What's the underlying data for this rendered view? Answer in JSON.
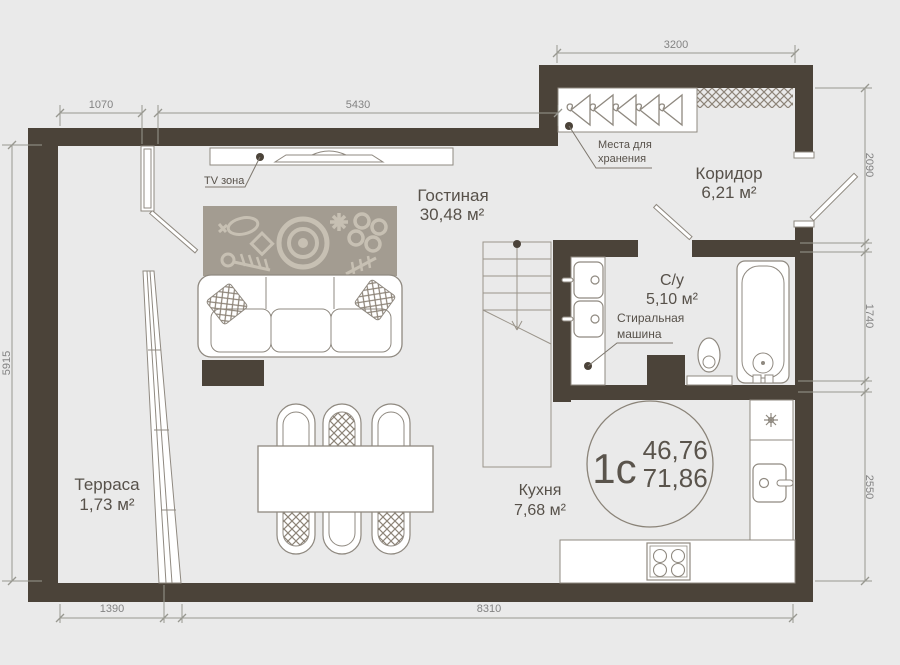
{
  "colors": {
    "background": "#eaeaea",
    "wall": "#4b4339",
    "furniture_outline": "#8f8980",
    "rug": "#a39c91",
    "rug_motif": "#c7c0b3",
    "pattern_accent": "#8d8478",
    "label_text": "#57514a",
    "dimension_text": "#838383"
  },
  "rooms": [
    {
      "id": "living",
      "name": "Гостиная",
      "area": "30,48 м²"
    },
    {
      "id": "corridor",
      "name": "Коридор",
      "area": "6,21 м²"
    },
    {
      "id": "bathroom",
      "name": "С/у",
      "area": "5,10 м²"
    },
    {
      "id": "kitchen",
      "name": "Кухня",
      "area": "7,68  м²"
    },
    {
      "id": "terrace",
      "name": "Терраса",
      "area": "1,73 м²"
    }
  ],
  "annotations": {
    "tv_zone": "TV зона",
    "storage": [
      "Места для",
      "хранения"
    ],
    "washing_machine": [
      "Стиральная",
      "машина"
    ]
  },
  "badge": {
    "plan_type": "1с",
    "living_area": "46,76",
    "total_area": "71,86"
  },
  "dimensions": {
    "top_left": "1070",
    "top_center": "5430",
    "top_right": "3200",
    "right_top": "2090",
    "right_middle": "1740",
    "right_bottom": "2550",
    "left_side": "5915",
    "bottom_left": "1390",
    "bottom_center": "8310"
  }
}
